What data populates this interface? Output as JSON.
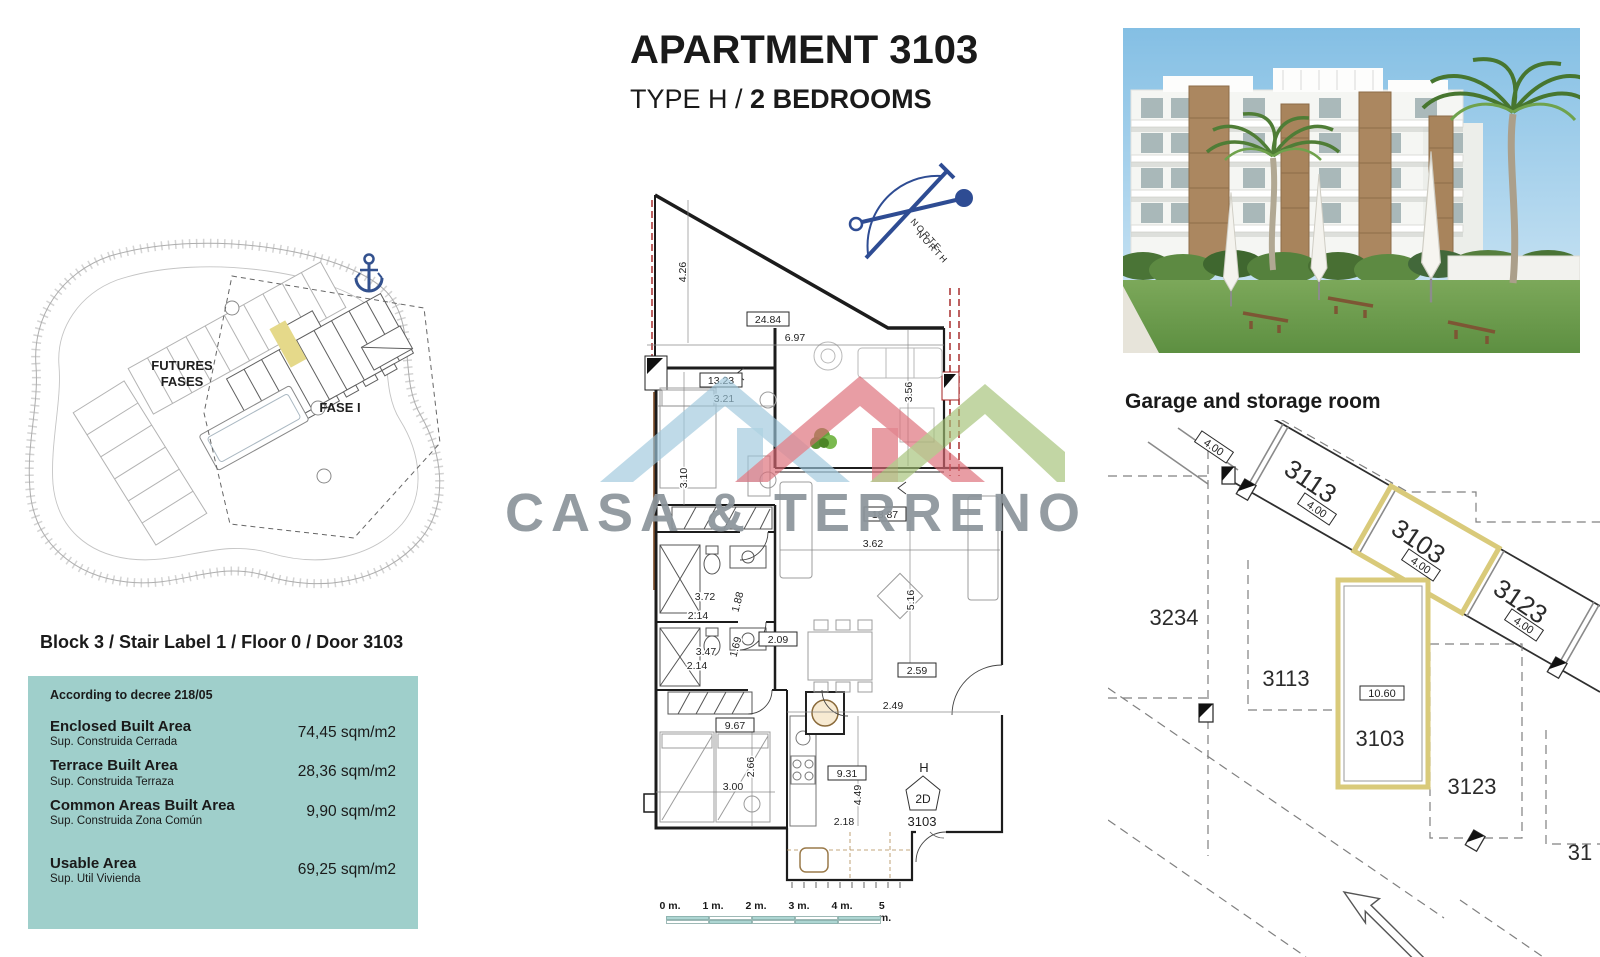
{
  "title": {
    "line1": "APARTMENT 3103",
    "line2_prefix": "TYPE H /",
    "line2_bold": "2 BEDROOMS"
  },
  "watermark": {
    "brand": "CASA & TERRENO"
  },
  "site_plan": {
    "futures_line1": "FUTURES",
    "futures_line2": "FASES",
    "fase": "FASE I"
  },
  "block_heading": "Block 3 / Stair Label 1 / Floor 0 / Door 3103",
  "area_panel": {
    "decree": "According to decree 218/05",
    "rows": [
      {
        "en": "Enclosed Built Area",
        "es": "Sup. Construida Cerrada",
        "value": "74,45 sqm/m2"
      },
      {
        "en": "Terrace Built Area",
        "es": "Sup. Construida Terraza",
        "value": "28,36 sqm/m2"
      },
      {
        "en": "Common Areas Built Area",
        "es": "Sup. Construida Zona Común",
        "value": "9,90 sqm/m2"
      },
      {
        "en": "Usable Area",
        "es": "Sup. Util Vivienda",
        "value": "69,25 sqm/m2"
      }
    ]
  },
  "floor_plan": {
    "compass": {
      "norte": "NORTE",
      "north": "NORTH"
    },
    "entry": {
      "h": "H",
      "type_2d": "2D",
      "door": "3103"
    },
    "dims": {
      "v426": "4.26",
      "v2484": "24.84",
      "v697": "6.97",
      "v1323": "13.23",
      "v321": "3.21",
      "v310": "3.10",
      "v356": "3.56",
      "v1887": "18.87",
      "v362": "3.62",
      "v516": "5.16",
      "v372": "3.72",
      "v214a": "2.14",
      "v188": "1.88",
      "v209": "2.09",
      "v347": "3.47",
      "v214b": "2.14",
      "v169": "1.69",
      "v967": "9.67",
      "v300": "3.00",
      "v266": "2.66",
      "v249": "2.49",
      "v259": "2.59",
      "v931": "9.31",
      "v449": "4.49",
      "v218": "2.18"
    },
    "scale_bar": [
      "0 m.",
      "1 m.",
      "2 m.",
      "3 m.",
      "4 m.",
      "5 m."
    ]
  },
  "garage": {
    "heading": "Garage and storage room",
    "slots": {
      "top": "3113",
      "middle": "3103",
      "bottom": "3123"
    },
    "dims": {
      "v400": "4.00",
      "v1060": "10.60"
    },
    "storage": {
      "a3234": "3234",
      "a3113": "3113",
      "a3103": "3103",
      "a3123": "3123",
      "partial": "31"
    }
  },
  "colors": {
    "panel_teal": "#9fcfcb",
    "scale_teal": "#aed6d3",
    "highlight_yellow": "#d9ca7a",
    "logo_blue": "#9ec8dc",
    "logo_red": "#dc6a76",
    "logo_green": "#a2c276",
    "compass_blue": "#2e4c93",
    "watermark_gray": "#8c959b",
    "section_red": "#a32020"
  }
}
